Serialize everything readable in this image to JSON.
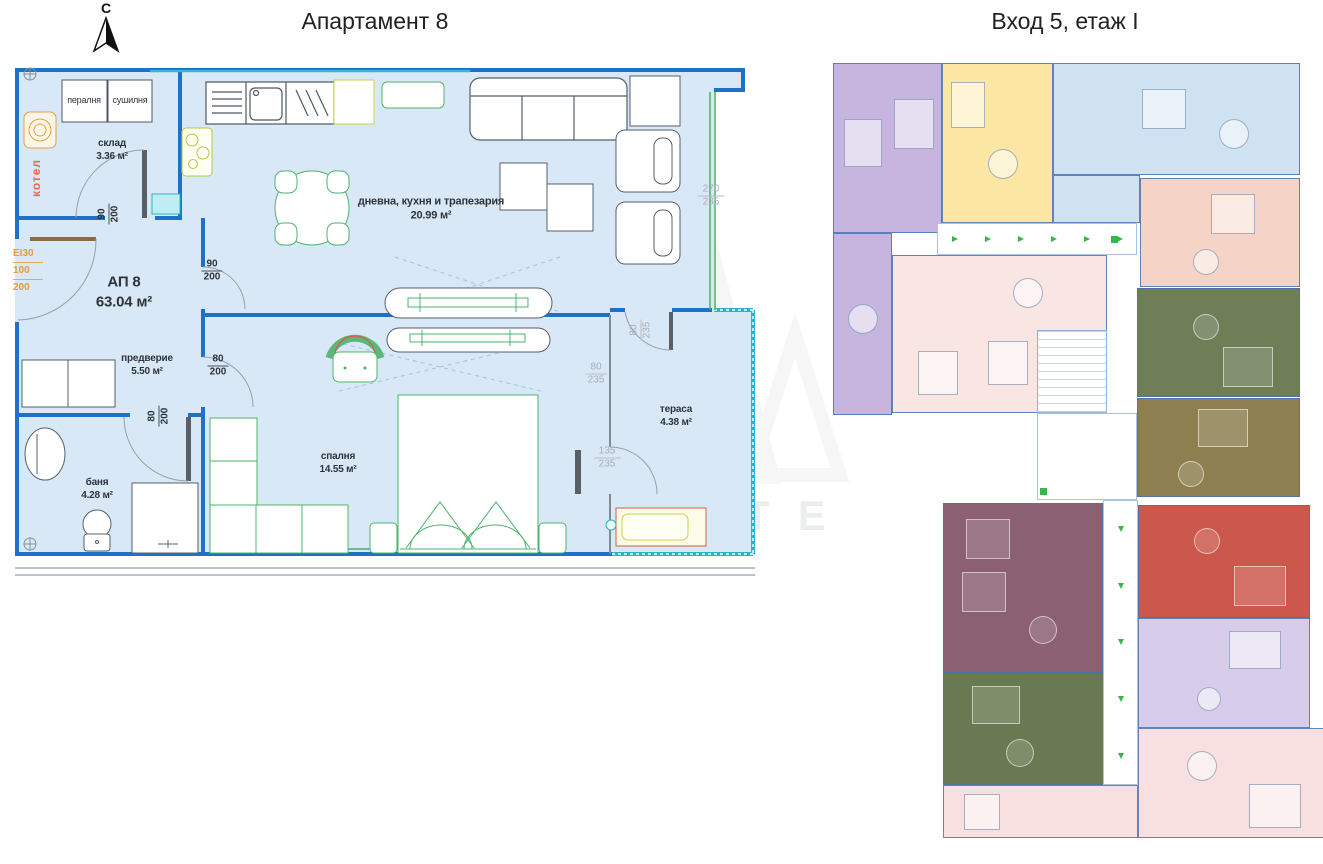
{
  "titles": {
    "left": "Апартамент 8",
    "right": "Вход 5, етаж I"
  },
  "compass": {
    "label": "С"
  },
  "apartment": {
    "name": "АП 8",
    "area": "63.04 м²"
  },
  "rooms": {
    "storage": {
      "name": "склад",
      "area": "3.36 м²"
    },
    "living": {
      "name": "дневна, кухня и трапезария",
      "area": "20.99 м²"
    },
    "hall": {
      "name": "предверие",
      "area": "5.50 м²"
    },
    "bath": {
      "name": "баня",
      "area": "4.28 м²"
    },
    "bedroom": {
      "name": "спалня",
      "area": "14.55 м²"
    },
    "terrace": {
      "name": "тераса",
      "area": "4.38 м²"
    }
  },
  "appliances": {
    "washer": "пералня",
    "dryer": "сушилня",
    "boiler": "котел"
  },
  "door_spec": {
    "rating": "ЕІ30",
    "width": "100",
    "height": "200"
  },
  "dims": {
    "storage_door": {
      "w": "90",
      "h": "200"
    },
    "kitchen_door": {
      "w": "90",
      "h": "200"
    },
    "bedroom_door": {
      "w": "80",
      "h": "200"
    },
    "bath_door": {
      "w": "80",
      "h": "200"
    },
    "living_window": {
      "w": "270",
      "h": "235"
    },
    "terrace_upper": {
      "w": "80",
      "h": "235"
    },
    "terrace_door_side": {
      "w": "80",
      "h": "235"
    },
    "terrace_window": {
      "w": "135",
      "h": "235"
    }
  },
  "watermark": {
    "text": "ESTATE"
  },
  "colors": {
    "plan_bg": "#d9e8f6",
    "wall_blue": "#1d72c8",
    "terrace_teal": "#2ab5c6",
    "furniture_green": "#4db36b",
    "spec_orange": "#e39b3d",
    "boiler_red": "#e8694b"
  },
  "right_plan": {
    "units": [
      {
        "id": "top-left-purple",
        "color": "#c7b5e0"
      },
      {
        "id": "top-middle-yellow",
        "color": "#fbe7a3"
      },
      {
        "id": "top-right-blue",
        "color": "#cfe2f1"
      },
      {
        "id": "right-salmon",
        "color": "#f5d3c6"
      },
      {
        "id": "right-darkgreen",
        "color": "#6f7e57"
      },
      {
        "id": "right-khaki",
        "color": "#8d7f50"
      },
      {
        "id": "right-red",
        "color": "#cc574d"
      },
      {
        "id": "right-lavender",
        "color": "#d8cceb"
      },
      {
        "id": "bottom-right-pink",
        "color": "#f7e0df"
      },
      {
        "id": "center-mauve",
        "color": "#8b6072"
      },
      {
        "id": "bottom-darkgreen",
        "color": "#697a52"
      },
      {
        "id": "bottom-pink",
        "color": "#f7e0df"
      },
      {
        "id": "center-pink",
        "color": "#f9e6e3"
      }
    ]
  }
}
